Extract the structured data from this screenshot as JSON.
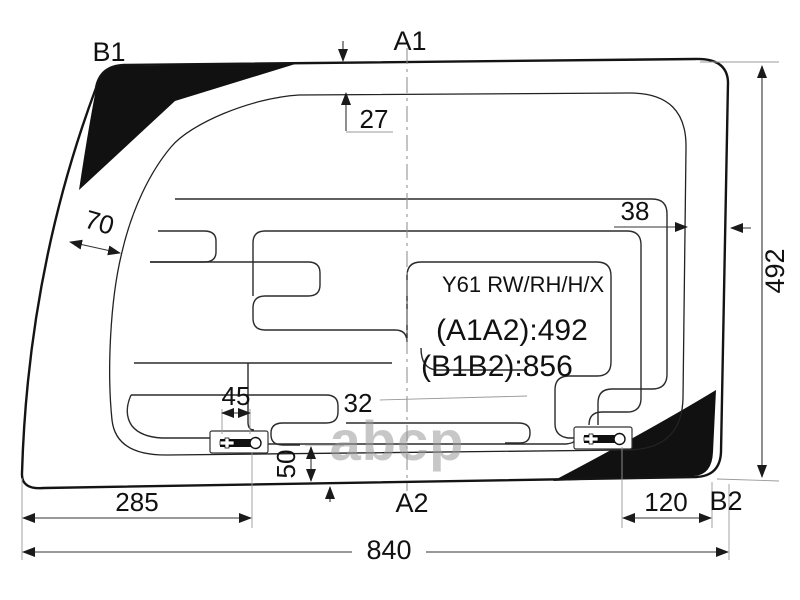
{
  "diagram_title": "Rear window glass with heater grid - dimensional drawing",
  "labels": {
    "b1": "B1",
    "a1": "A1",
    "a2": "A2",
    "b2": "B2"
  },
  "info": {
    "model": "Y61 RW/RH/H/X",
    "a1a2": "(A1A2):492",
    "b1b2": "(B1B2):856"
  },
  "dims": {
    "top_band": "27",
    "right_band": "38",
    "left_band": "70",
    "height": "492",
    "terminal_width": "45",
    "row_gap": "32",
    "bottom_gap": "50",
    "left_terminal_offset": "285",
    "right_terminal_offset": "120",
    "total_width": "840"
  },
  "watermark": "abcp",
  "colors": {
    "line": "#141414",
    "frit": "#111111",
    "dimension": "#333333",
    "watermark": "#9a9a9a"
  }
}
